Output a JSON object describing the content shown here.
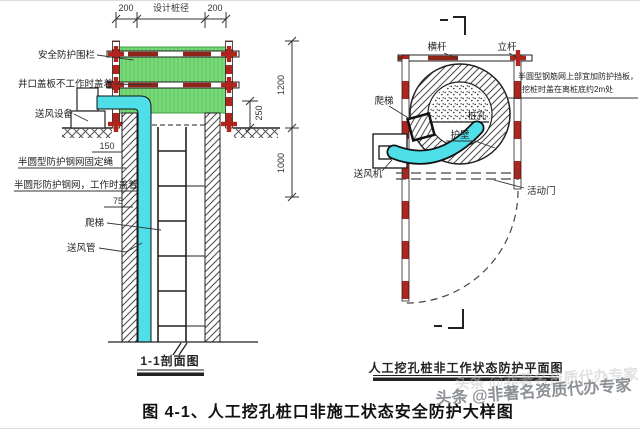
{
  "left": {
    "dims": {
      "top_left": "200",
      "top_mid": "设计桩径",
      "top_right": "200",
      "right_upper": "1200",
      "right_lower": "1000",
      "offset": "250",
      "wall_top": "150",
      "wall_mid": "75"
    },
    "labels": {
      "fence": "安全防护围栏",
      "cover": "井口盖板不工作时盖着",
      "air_supply": "送风设备",
      "net_rope": "半圆型防护钢网固定绳",
      "net_cover": "半圆形防护钢网，工作时盖着",
      "ladder": "爬梯",
      "air_duct": "送风管"
    },
    "caption": "1-1剖面图"
  },
  "right": {
    "labels": {
      "rail": "横杆",
      "pole": "立杆",
      "ladder": "爬梯",
      "pile_hole": "桩孔",
      "lining": "护壁",
      "blower": "送风机",
      "door": "活动门"
    },
    "note_line1": "半圆型钢筋网上部宜加防护挡板，",
    "note_line2": "挖桩时盖在离桩底约2m处",
    "caption": "人工挖孔桩非工作状态防护平面图"
  },
  "figure_caption": "图 4-1、人工挖孔桩口非施工状态安全防护大样图",
  "watermark": "头条 @非著名资质代办专家",
  "colors": {
    "scaffold_red": "#b0241c",
    "rail_red": "#8f2418",
    "mesh_green": "#79db79",
    "duct_cyan": "#4fdfe8",
    "line_ink": "#222222",
    "watermark_gray": "#8d9094"
  }
}
